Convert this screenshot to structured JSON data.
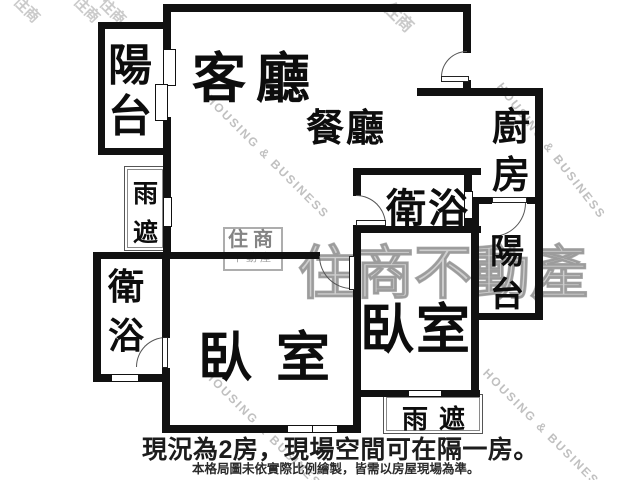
{
  "colors": {
    "wall": "#111111",
    "door_line": "#555555",
    "watermark_gray": "#8a8a8a",
    "text": "#0d0d0d"
  },
  "rooms": {
    "living": {
      "label": "客廳"
    },
    "dining": {
      "label": "餐廳"
    },
    "kitchen": {
      "label": "廚房"
    },
    "bath_main": {
      "label": "衛浴"
    },
    "bath_second": {
      "label": "衛浴"
    },
    "balcony_front": {
      "label": "陽台"
    },
    "balcony_rear": {
      "label": "陽台"
    },
    "bedroom_left": {
      "label": "臥室"
    },
    "bedroom_right": {
      "label": "臥室"
    },
    "canopy_left": {
      "label": "雨遮"
    },
    "canopy_bottom": {
      "label": "雨遮"
    }
  },
  "captions": {
    "headline": "現況為2房，現場空間可在隔一房。",
    "disclaimer": "本格局圖未依實際比例繪製，皆需以房屋現場為準。"
  },
  "watermark": {
    "brand": "住商不動產",
    "brand_short": "住商",
    "brand_sub": "不動產",
    "company_en": "HOUSING & BUSINESS",
    "fragment": "住商"
  }
}
